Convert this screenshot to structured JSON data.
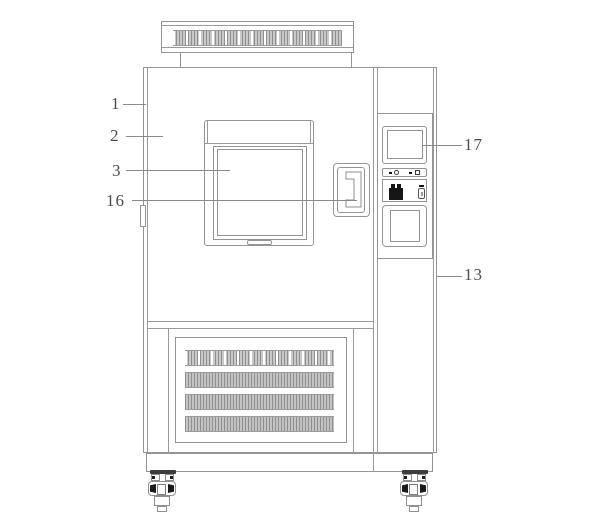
{
  "figure": {
    "subject": "patent-style front elevation line drawing of a test chamber cabinet",
    "colors": {
      "background": "#ffffff",
      "line": "#949494",
      "label_text": "#4c4c4c",
      "hatch_fill": "#c9c9c9",
      "button_black": "#161616"
    }
  },
  "labels": {
    "l1": "1",
    "l2": "2",
    "l3": "3",
    "l16": "16",
    "l17": "17",
    "l13": "13"
  }
}
